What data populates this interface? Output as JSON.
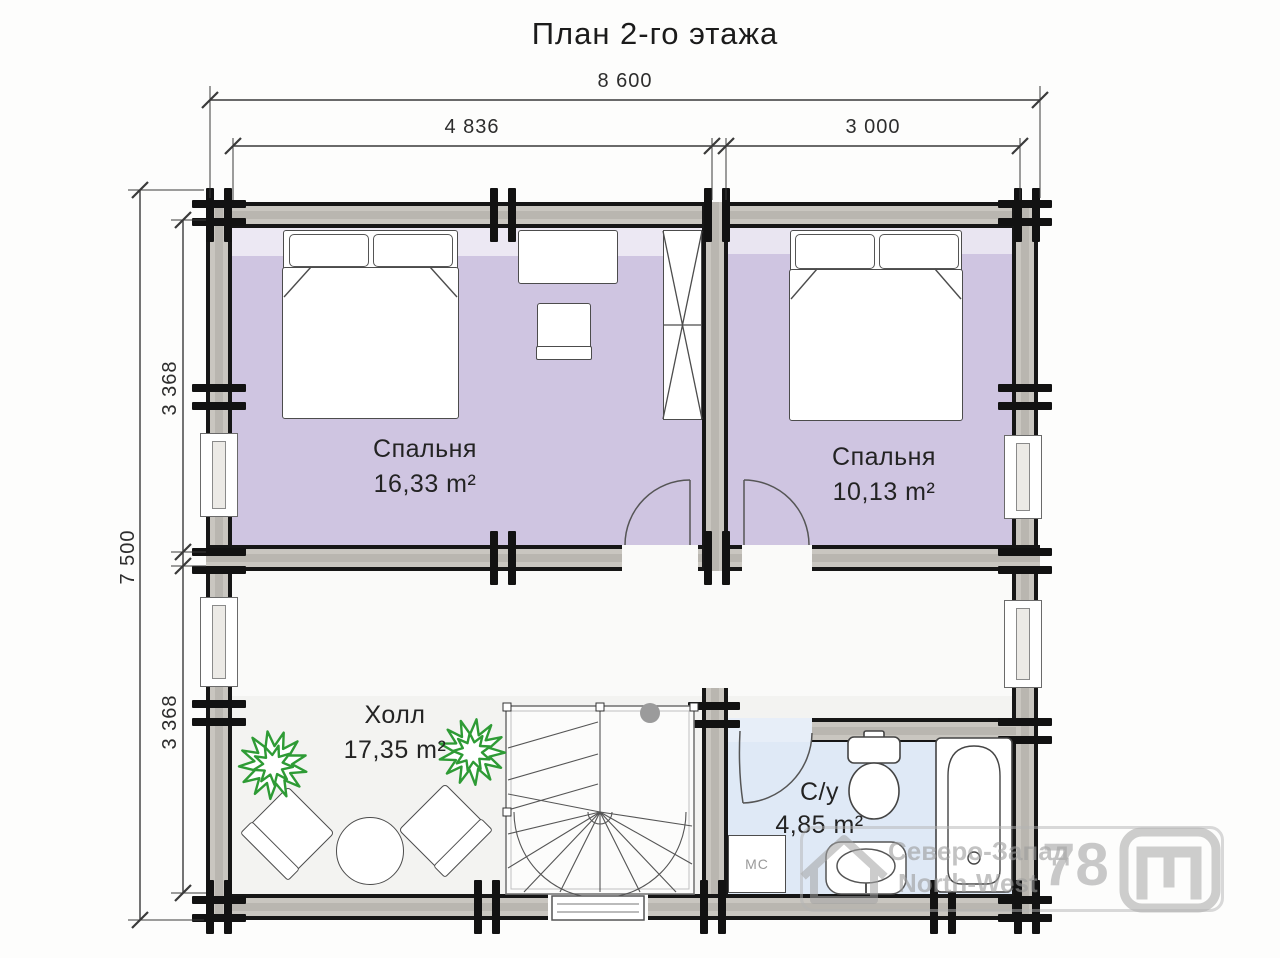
{
  "title": "План 2-го этажа",
  "dimensions": {
    "top_total": "8 600",
    "top_left": "4 836",
    "top_right": "3 000",
    "left_total": "7 500",
    "left_upper": "3 368",
    "left_lower": "3 368"
  },
  "rooms": {
    "bedroom1": {
      "name": "Спальня",
      "area": "16,33 m²"
    },
    "bedroom2": {
      "name": "Спальня",
      "area": "10,13 m²"
    },
    "hall": {
      "name": "Холл",
      "area": "17,35 m²"
    },
    "bathroom": {
      "name": "С/у",
      "area": "4,85 m²"
    }
  },
  "labels": {
    "washing_machine": "МС"
  },
  "watermark": {
    "company_ru": "Северо-Запад",
    "company_en": "North-West",
    "region_code": "78"
  },
  "colors": {
    "bedroom_floor": "#cfc5e1",
    "hall_floor": "#f3f3f1",
    "bathroom_floor": "#dfe9f6",
    "wall_black": "#161616",
    "wall_core": "#c9c6c0",
    "plant_green": "#2e9b35",
    "watermark_gray": "#a3a3a3"
  }
}
